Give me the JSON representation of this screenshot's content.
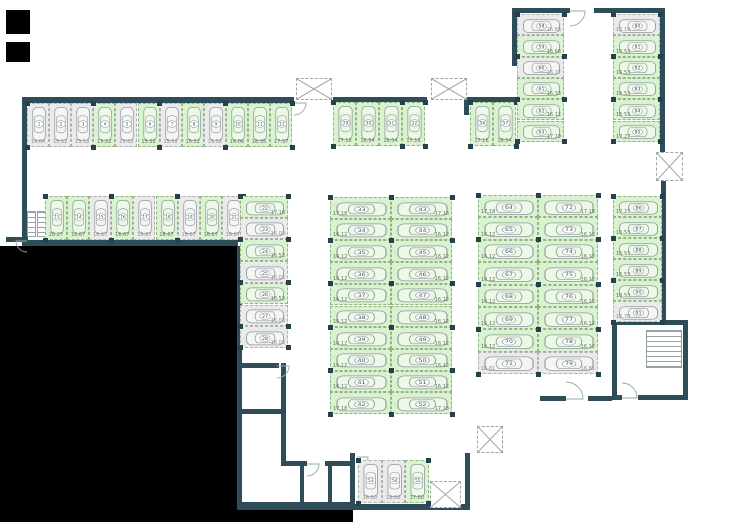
{
  "colors": {
    "free_space": "#d9f2cf",
    "occupied_space": "#eaeaea",
    "wall": "#2e4d58",
    "background": "#ffffff",
    "void": "#000000"
  },
  "plan": {
    "width": 754,
    "height": 522,
    "black_regions": [
      [
        6,
        10,
        24,
        24
      ],
      [
        6,
        42,
        24,
        20
      ],
      [
        0,
        246,
        237,
        276
      ],
      [
        237,
        510,
        116,
        12
      ]
    ],
    "walls": [
      [
        22,
        97,
        272,
        6
      ],
      [
        22,
        97,
        5,
        146
      ],
      [
        6,
        237,
        22,
        5
      ],
      [
        22,
        240,
        216,
        6
      ],
      [
        333,
        97,
        94,
        5
      ],
      [
        464,
        97,
        54,
        6
      ],
      [
        464,
        97,
        5,
        18
      ],
      [
        512,
        8,
        58,
        5
      ],
      [
        512,
        8,
        5,
        58
      ],
      [
        594,
        8,
        70,
        5
      ],
      [
        660,
        8,
        5,
        144
      ],
      [
        661,
        181,
        5,
        141
      ],
      [
        612,
        320,
        76,
        5
      ],
      [
        612,
        320,
        5,
        80
      ],
      [
        612,
        395,
        10,
        5
      ],
      [
        638,
        395,
        50,
        5
      ],
      [
        683,
        320,
        5,
        80
      ],
      [
        540,
        396,
        26,
        5
      ],
      [
        588,
        396,
        24,
        5
      ],
      [
        237,
        246,
        5,
        264
      ],
      [
        237,
        363,
        42,
        5
      ],
      [
        281,
        363,
        5,
        102
      ],
      [
        237,
        409,
        46,
        5
      ],
      [
        281,
        461,
        26,
        5
      ],
      [
        325,
        461,
        28,
        5
      ],
      [
        350,
        453,
        5,
        57
      ],
      [
        237,
        502,
        118,
        8
      ],
      [
        300,
        466,
        4,
        38
      ],
      [
        328,
        466,
        4,
        38
      ],
      [
        465,
        453,
        5,
        57
      ],
      [
        352,
        504,
        118,
        6
      ]
    ],
    "shafts": [
      [
        296,
        78,
        36,
        22
      ],
      [
        431,
        78,
        36,
        22
      ],
      [
        656,
        152,
        27,
        29
      ],
      [
        477,
        426,
        26,
        27
      ],
      [
        430,
        481,
        31,
        27
      ]
    ],
    "stairs": [
      [
        27,
        211,
        9,
        26
      ],
      [
        37,
        211,
        9,
        26
      ],
      [
        646,
        330,
        36,
        38
      ]
    ],
    "doors": [
      {
        "x": 294,
        "y": 103,
        "r": 12,
        "q": "se"
      },
      {
        "x": 469,
        "y": 103,
        "r": 11,
        "q": "se"
      },
      {
        "x": 570,
        "y": 11,
        "r": 15,
        "q": "se"
      },
      {
        "x": 27,
        "y": 241,
        "r": 11,
        "q": "sw"
      },
      {
        "x": 277,
        "y": 366,
        "r": 12,
        "q": "se"
      },
      {
        "x": 307,
        "y": 464,
        "r": 12,
        "q": "se"
      },
      {
        "x": 357,
        "y": 457,
        "r": 11,
        "q": "se"
      },
      {
        "x": 622,
        "y": 398,
        "r": 15,
        "q": "ne"
      },
      {
        "x": 566,
        "y": 399,
        "r": 17,
        "q": "ne"
      }
    ],
    "parking_groups": [
      {
        "id": "row-top-left",
        "orient": "v",
        "x": 27,
        "y": 103,
        "sw": 22.1,
        "sh": 44,
        "label_side": "bottom",
        "spaces": [
          [
            1,
            "14.04",
            "o"
          ],
          [
            2,
            "15.52",
            "o"
          ],
          [
            3,
            "15.52",
            "o"
          ],
          [
            4,
            "15.52",
            "f"
          ],
          [
            5,
            "15.52",
            "o"
          ],
          [
            6,
            "15.52",
            "f"
          ],
          [
            7,
            "15.52",
            "o"
          ],
          [
            8,
            "15.52",
            "f"
          ],
          [
            9,
            "15.52",
            "o"
          ],
          [
            10,
            "16.06",
            "f"
          ],
          [
            11,
            "16.35",
            "f"
          ],
          [
            12,
            "17.37",
            "f"
          ]
        ]
      },
      {
        "id": "row-mid-left",
        "orient": "v",
        "x": 45,
        "y": 196,
        "sw": 22.1,
        "sh": 44,
        "label_side": "bottom",
        "spaces": [
          [
            13,
            "20.27",
            "f"
          ],
          [
            14,
            "16.67",
            "f"
          ],
          [
            15,
            "16.67",
            "o"
          ],
          [
            16,
            "16.67",
            "f"
          ],
          [
            17,
            "16.67",
            "o"
          ],
          [
            18,
            "16.67",
            "f"
          ],
          [
            19,
            "16.67",
            "o"
          ],
          [
            20,
            "16.67",
            "f"
          ],
          [
            21,
            "16.67",
            "o"
          ]
        ]
      },
      {
        "id": "col-22-28",
        "orient": "h",
        "x": 240,
        "y": 196,
        "sw": 48,
        "sh": 21.7,
        "label_side": "right",
        "spaces": [
          [
            22,
            "17.18",
            "f"
          ],
          [
            23,
            "16.03",
            "o"
          ],
          [
            24,
            "16.53",
            "f"
          ],
          [
            25,
            "16.03",
            "o"
          ],
          [
            26,
            "16.53",
            "f"
          ],
          [
            27,
            "16.03",
            "o"
          ],
          [
            28,
            "16.03",
            "o"
          ]
        ]
      },
      {
        "id": "row-top-mid",
        "orient": "v",
        "x": 333,
        "y": 102,
        "sw": 23,
        "sh": 44,
        "label_side": "bottom",
        "spaces": [
          [
            29,
            "17.16",
            "f"
          ],
          [
            30,
            "16.54",
            "f"
          ],
          [
            31,
            "16.54",
            "f"
          ],
          [
            32,
            "17.16",
            "f"
          ]
        ]
      },
      {
        "id": "col-center-left",
        "orient": "h",
        "x": 330,
        "y": 197,
        "sw": 61,
        "sh": 21.7,
        "label_side": "left",
        "spaces": [
          [
            33,
            "17.18",
            "f"
          ],
          [
            34,
            "16.12",
            "f"
          ],
          [
            35,
            "16.12",
            "f"
          ],
          [
            36,
            "16.12",
            "f"
          ],
          [
            37,
            "16.12",
            "f"
          ],
          [
            38,
            "16.12",
            "f"
          ],
          [
            39,
            "16.12",
            "f"
          ],
          [
            40,
            "16.12",
            "f"
          ],
          [
            41,
            "16.12",
            "f"
          ],
          [
            42,
            "17.18",
            "f"
          ]
        ]
      },
      {
        "id": "col-center-right",
        "orient": "h",
        "x": 391,
        "y": 197,
        "sw": 61,
        "sh": 21.7,
        "label_side": "right",
        "spaces": [
          [
            43,
            "17.18",
            "f"
          ],
          [
            44,
            "16.12",
            "f"
          ],
          [
            45,
            "16.12",
            "f"
          ],
          [
            46,
            "16.12",
            "f"
          ],
          [
            47,
            "16.12",
            "f"
          ],
          [
            48,
            "16.12",
            "f"
          ],
          [
            49,
            "16.12",
            "f"
          ],
          [
            50,
            "16.12",
            "f"
          ],
          [
            51,
            "16.12",
            "f"
          ],
          [
            52,
            "17.18",
            "f"
          ]
        ]
      },
      {
        "id": "row-bottom-mid",
        "orient": "v",
        "x": 358,
        "y": 460,
        "sw": 23.5,
        "sh": 43,
        "label_side": "bottom",
        "spaces": [
          [
            53,
            "16.00",
            "o"
          ],
          [
            54,
            "16.00",
            "o"
          ],
          [
            55,
            "17.00",
            "f"
          ]
        ]
      },
      {
        "id": "row-top-right-pair",
        "orient": "v",
        "x": 470,
        "y": 102,
        "sw": 23,
        "sh": 44,
        "label_side": "bottom",
        "spaces": [
          [
            56,
            "17.16",
            "f"
          ],
          [
            57,
            "16.54",
            "f"
          ]
        ]
      },
      {
        "id": "col-top-right-inner",
        "orient": "h",
        "x": 517,
        "y": 14,
        "sw": 47,
        "sh": 21.3,
        "label_side": "right",
        "spaces": [
          [
            58,
            "16.65",
            "o"
          ],
          [
            59,
            "16.66",
            "f"
          ],
          [
            60,
            "16.27",
            "o"
          ],
          [
            61,
            "16.33",
            "f"
          ],
          [
            62,
            "16.12",
            "f"
          ],
          [
            63,
            "17.19",
            "f"
          ]
        ]
      },
      {
        "id": "col-east-left",
        "orient": "h",
        "x": 478,
        "y": 195,
        "sw": 60,
        "sh": 22.4,
        "label_side": "left",
        "spaces": [
          [
            64,
            "17.18",
            "f"
          ],
          [
            65,
            "16.12",
            "f"
          ],
          [
            66,
            "16.12",
            "f"
          ],
          [
            67,
            "16.12",
            "f"
          ],
          [
            68,
            "16.12",
            "f"
          ],
          [
            69,
            "16.12",
            "f"
          ],
          [
            70,
            "16.12",
            "f"
          ],
          [
            71,
            "16.81",
            "o"
          ]
        ]
      },
      {
        "id": "col-east-right",
        "orient": "h",
        "x": 538,
        "y": 195,
        "sw": 60,
        "sh": 22.4,
        "label_side": "right",
        "spaces": [
          [
            72,
            "17.18",
            "f"
          ],
          [
            73,
            "16.12",
            "f"
          ],
          [
            74,
            "16.12",
            "f"
          ],
          [
            75,
            "16.12",
            "f"
          ],
          [
            76,
            "16.12",
            "f"
          ],
          [
            77,
            "16.12",
            "f"
          ],
          [
            78,
            "16.12",
            "f"
          ],
          [
            79,
            "16.81",
            "o"
          ]
        ]
      },
      {
        "id": "col-top-right-outer",
        "orient": "h",
        "x": 613,
        "y": 14,
        "sw": 47,
        "sh": 21.3,
        "label_side": "left",
        "spaces": [
          [
            80,
            "16.19",
            "o"
          ],
          [
            81,
            "16.53",
            "f"
          ],
          [
            82,
            "16.53",
            "f"
          ],
          [
            83,
            "16.53",
            "f"
          ],
          [
            84,
            "16.53",
            "f"
          ],
          [
            85,
            "17.27",
            "f"
          ]
        ]
      },
      {
        "id": "col-far-right",
        "orient": "h",
        "x": 613,
        "y": 196,
        "sw": 49,
        "sh": 21,
        "label_side": "left",
        "spaces": [
          [
            86,
            "17.27",
            "f"
          ],
          [
            87,
            "16.53",
            "f"
          ],
          [
            88,
            "16.53",
            "f"
          ],
          [
            89,
            "16.53",
            "f"
          ],
          [
            90,
            "16.53",
            "f"
          ],
          [
            91,
            "16.78",
            "o"
          ]
        ]
      }
    ]
  }
}
